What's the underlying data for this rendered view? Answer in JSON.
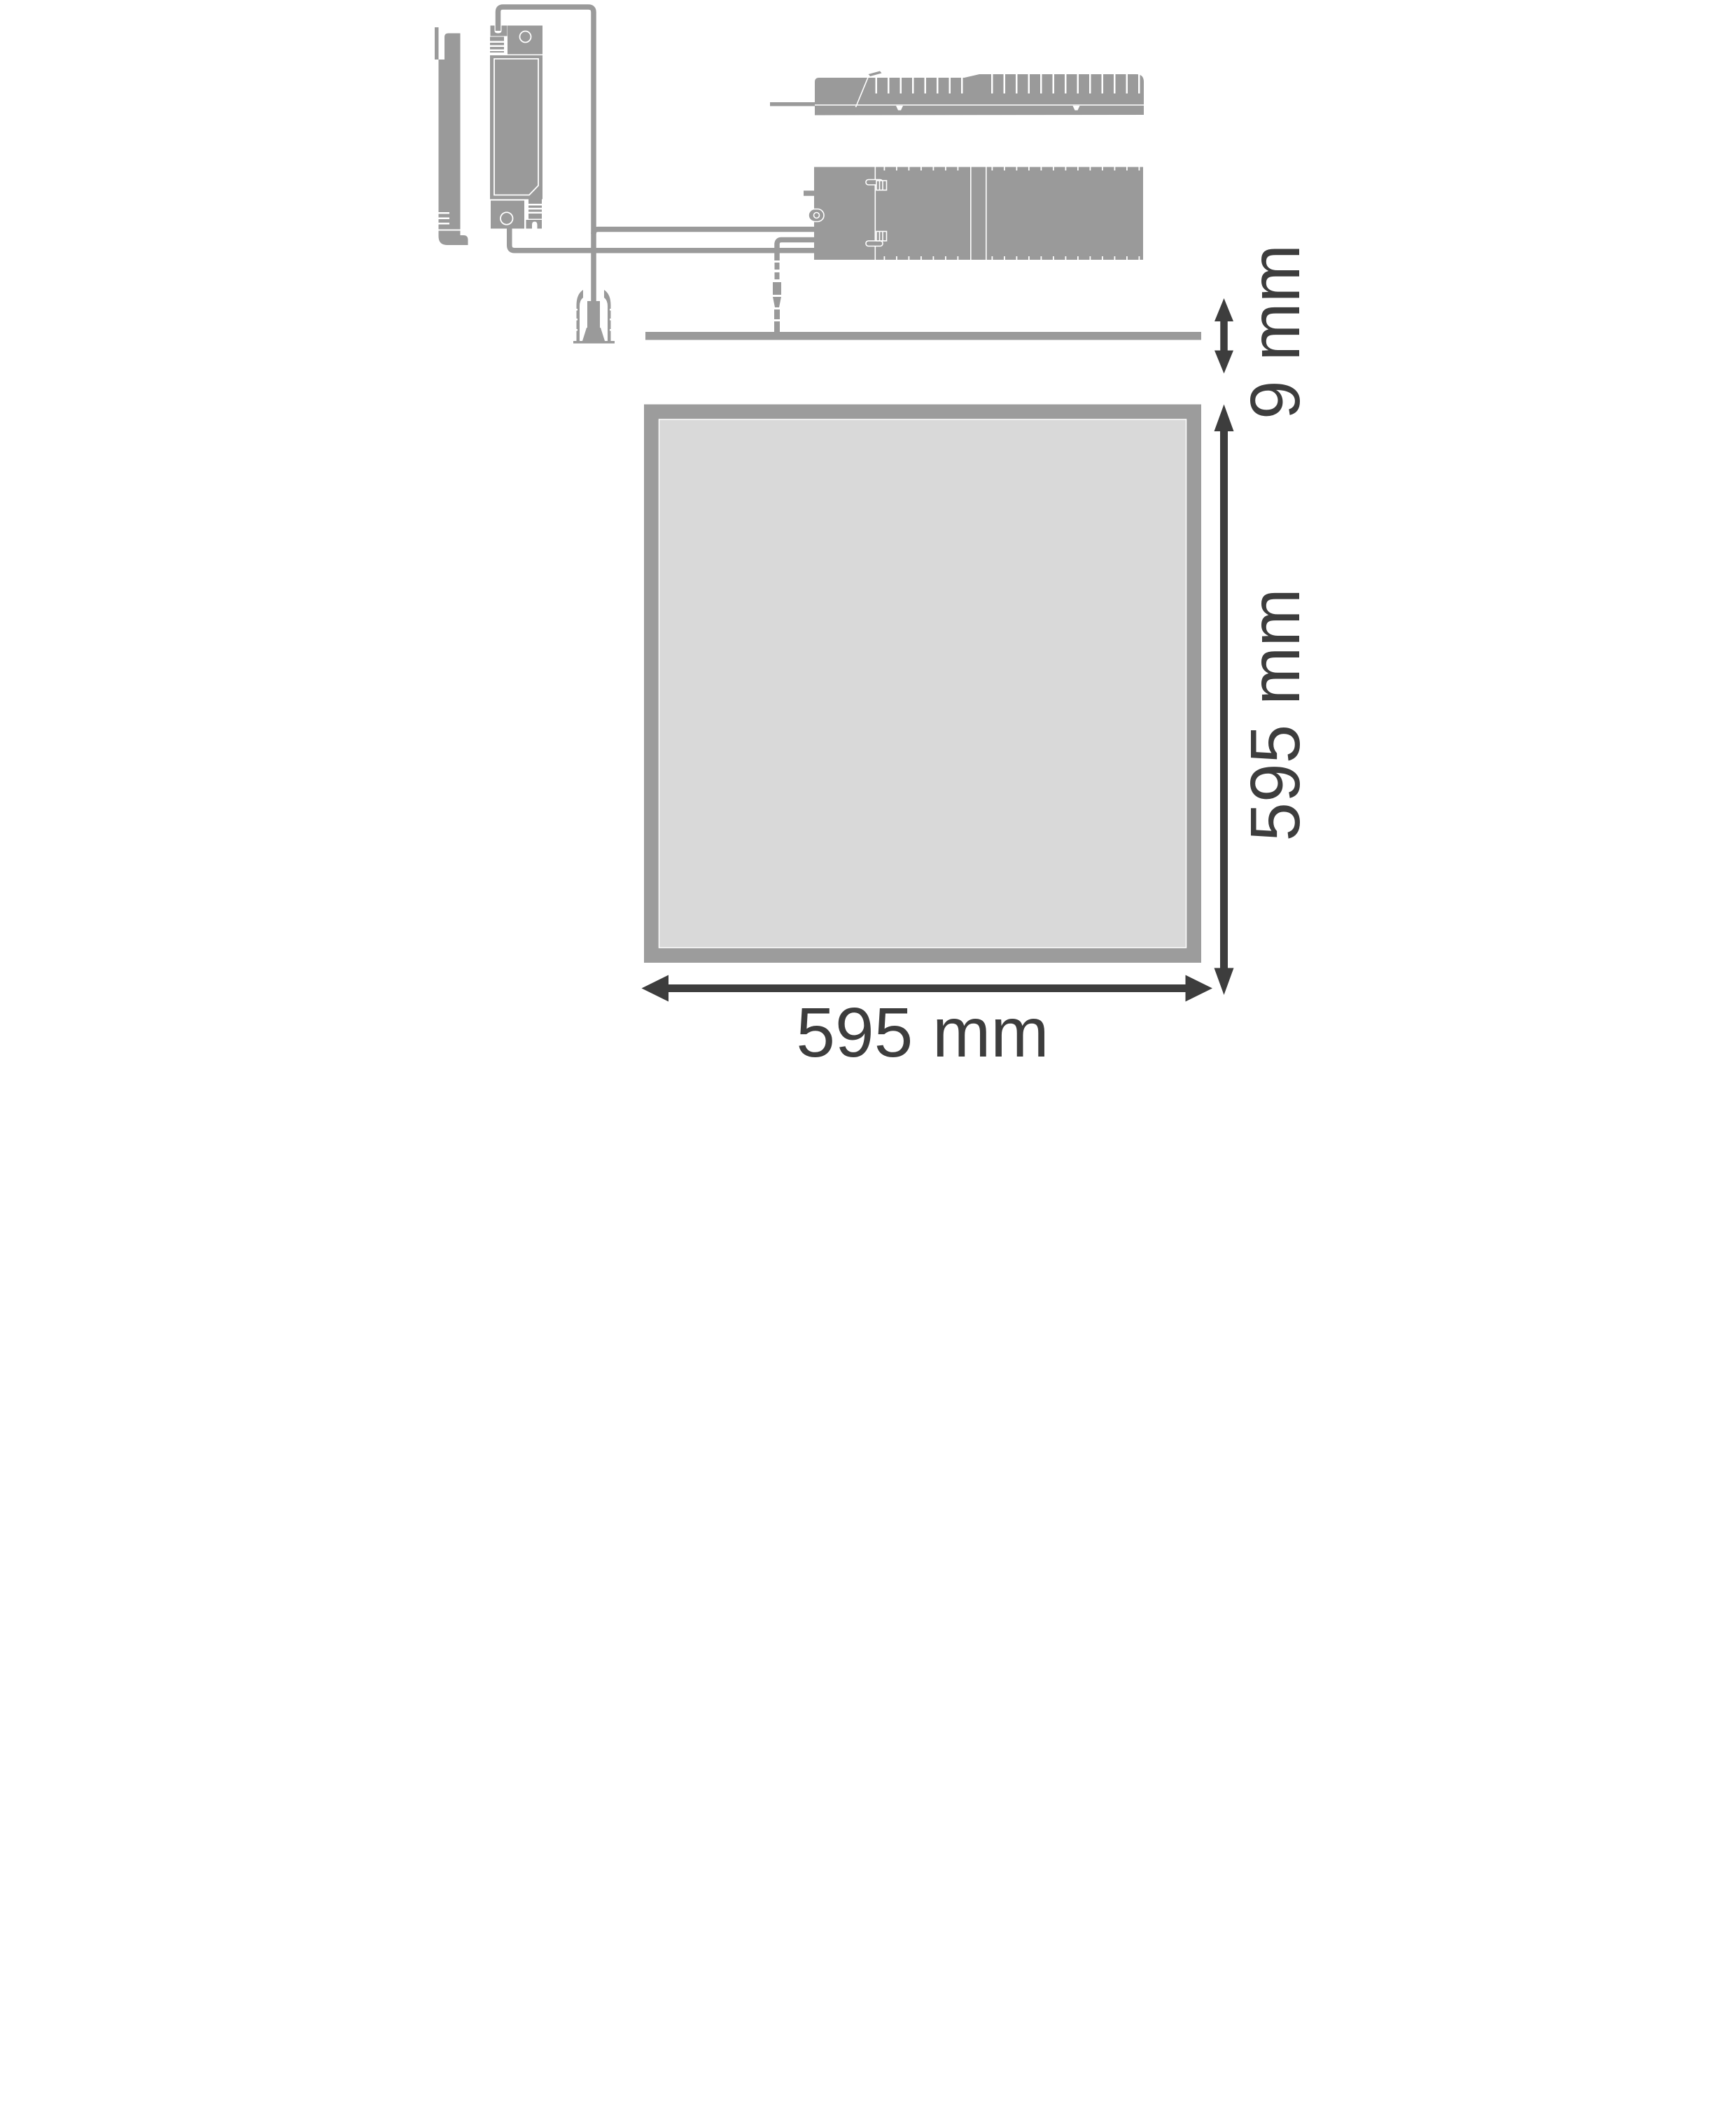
{
  "labels": {
    "panel_thickness": "9 mm",
    "panel_height": "595 mm",
    "panel_width": "595 mm"
  },
  "colors": {
    "component_grey": "#9a9a9a",
    "panel_frame_grey": "#9c9c9c",
    "panel_fill_grey": "#d9d9d9",
    "dimension_dark": "#3d3d3d",
    "background": "#ffffff"
  }
}
